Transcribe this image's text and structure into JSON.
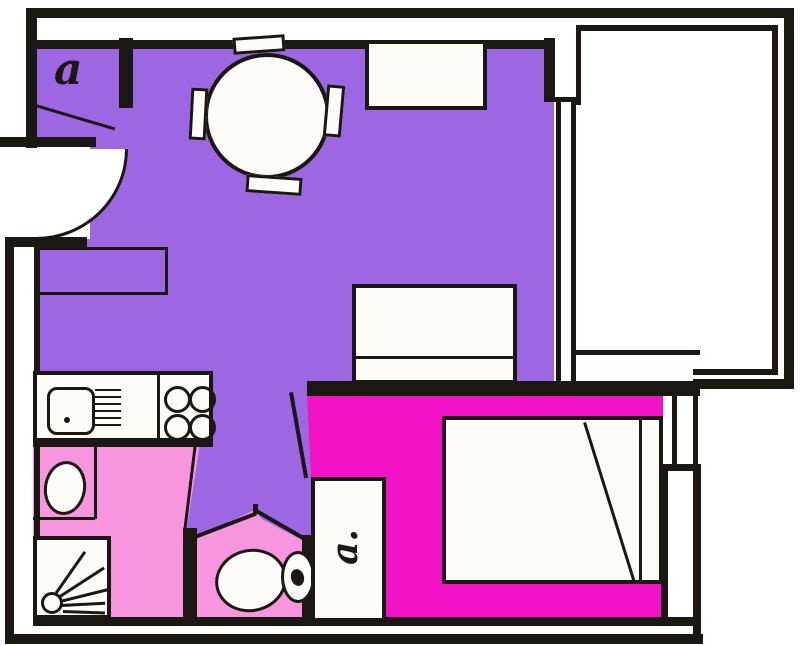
{
  "labels": {
    "hall_fixture": "a",
    "cupboard_fixture": "a."
  },
  "colors": {
    "living": "#9d67e4",
    "bath": "#f795de",
    "bedroom": "#f312c6",
    "wall": "#1b1712",
    "floor": "#fdfcf8",
    "bg": "#ffffff"
  }
}
